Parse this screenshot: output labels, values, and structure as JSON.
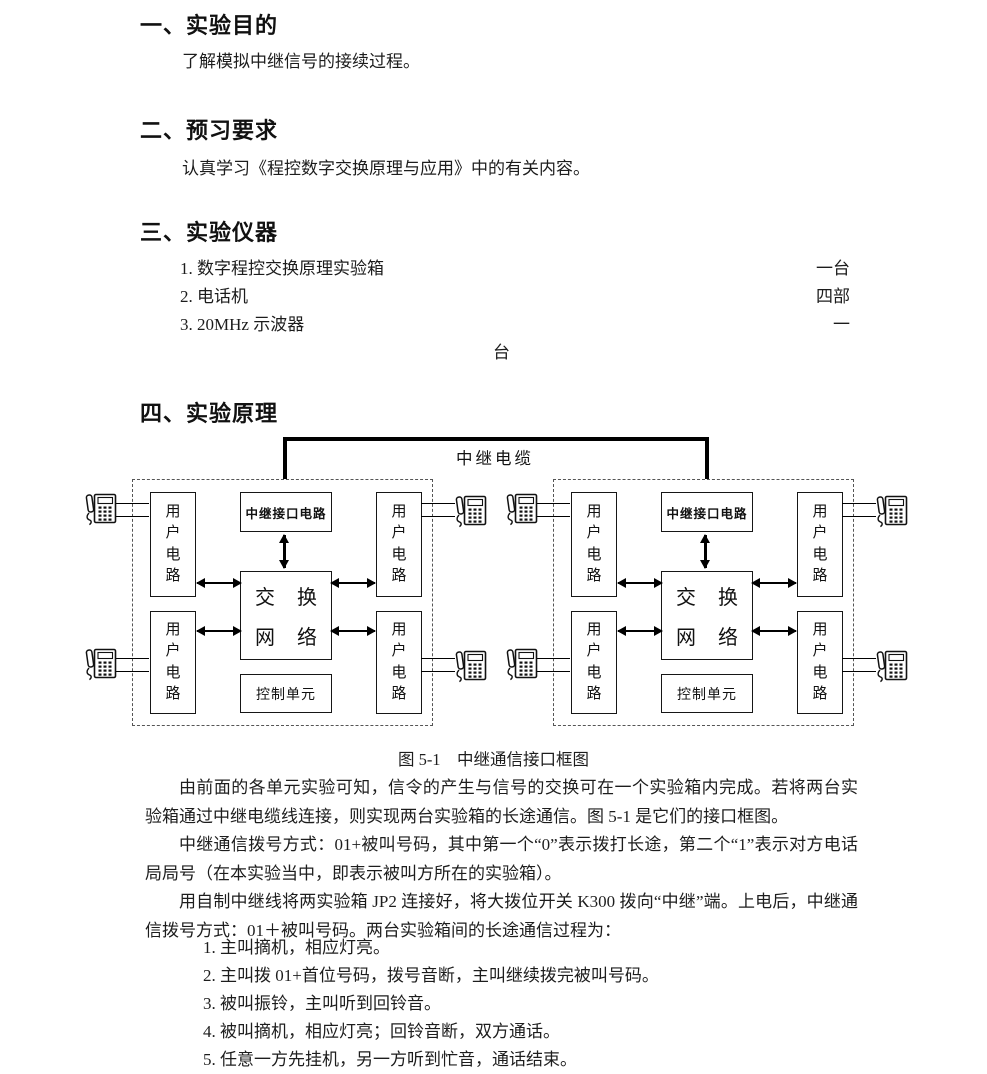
{
  "doc": {
    "section1": {
      "heading": "一、实验目的",
      "body": "了解模拟中继信号的接续过程。"
    },
    "section2": {
      "heading": "二、预习要求",
      "body": "认真学习《程控数字交换原理与应用》中的有关内容。"
    },
    "section3": {
      "heading": "三、实验仪器",
      "instruments": [
        {
          "label": "1. 数字程控交换原理实验箱",
          "count": "一台"
        },
        {
          "label": "2. 电话机",
          "count": "四部"
        },
        {
          "label": "3. 20MHz 示波器",
          "count": "一"
        }
      ],
      "count_overflow": "台"
    },
    "section4": {
      "heading": "四、实验原理"
    }
  },
  "diagram": {
    "cable_label": "中继电缆",
    "trunk_interface_label": "中继接口电路",
    "user_circuit_label": "用户电路",
    "switch_network_line1": "交 换",
    "switch_network_line2": "网 络",
    "control_unit_label": "控制单元",
    "caption": "图 5-1　中继通信接口框图"
  },
  "principle": {
    "p1": "由前面的各单元实验可知，信令的产生与信号的交换可在一个实验箱内完成。若将两台实验箱通过中继电缆线连接，则实现两台实验箱的长途通信。图 5-1 是它们的接口框图。",
    "p2": "中继通信拨号方式：01+被叫号码，其中第一个“0”表示拨打长途，第二个“1”表示对方电话局局号（在本实验当中，即表示被叫方所在的实验箱）。",
    "p3": "用自制中继线将两实验箱 JP2 连接好，将大拨位开关 K300 拨向“中继”端。上电后，中继通信拨号方式：01＋被叫号码。两台实验箱间的长途通信过程为：",
    "steps": [
      "1. 主叫摘机，相应灯亮。",
      "2. 主叫拨 01+首位号码，拨号音断，主叫继续拨完被叫号码。",
      "3. 被叫振铃，主叫听到回铃音。",
      "4. 被叫摘机，相应灯亮；回铃音断，双方通话。",
      "5. 任意一方先挂机，另一方听到忙音，通话结束。"
    ]
  }
}
